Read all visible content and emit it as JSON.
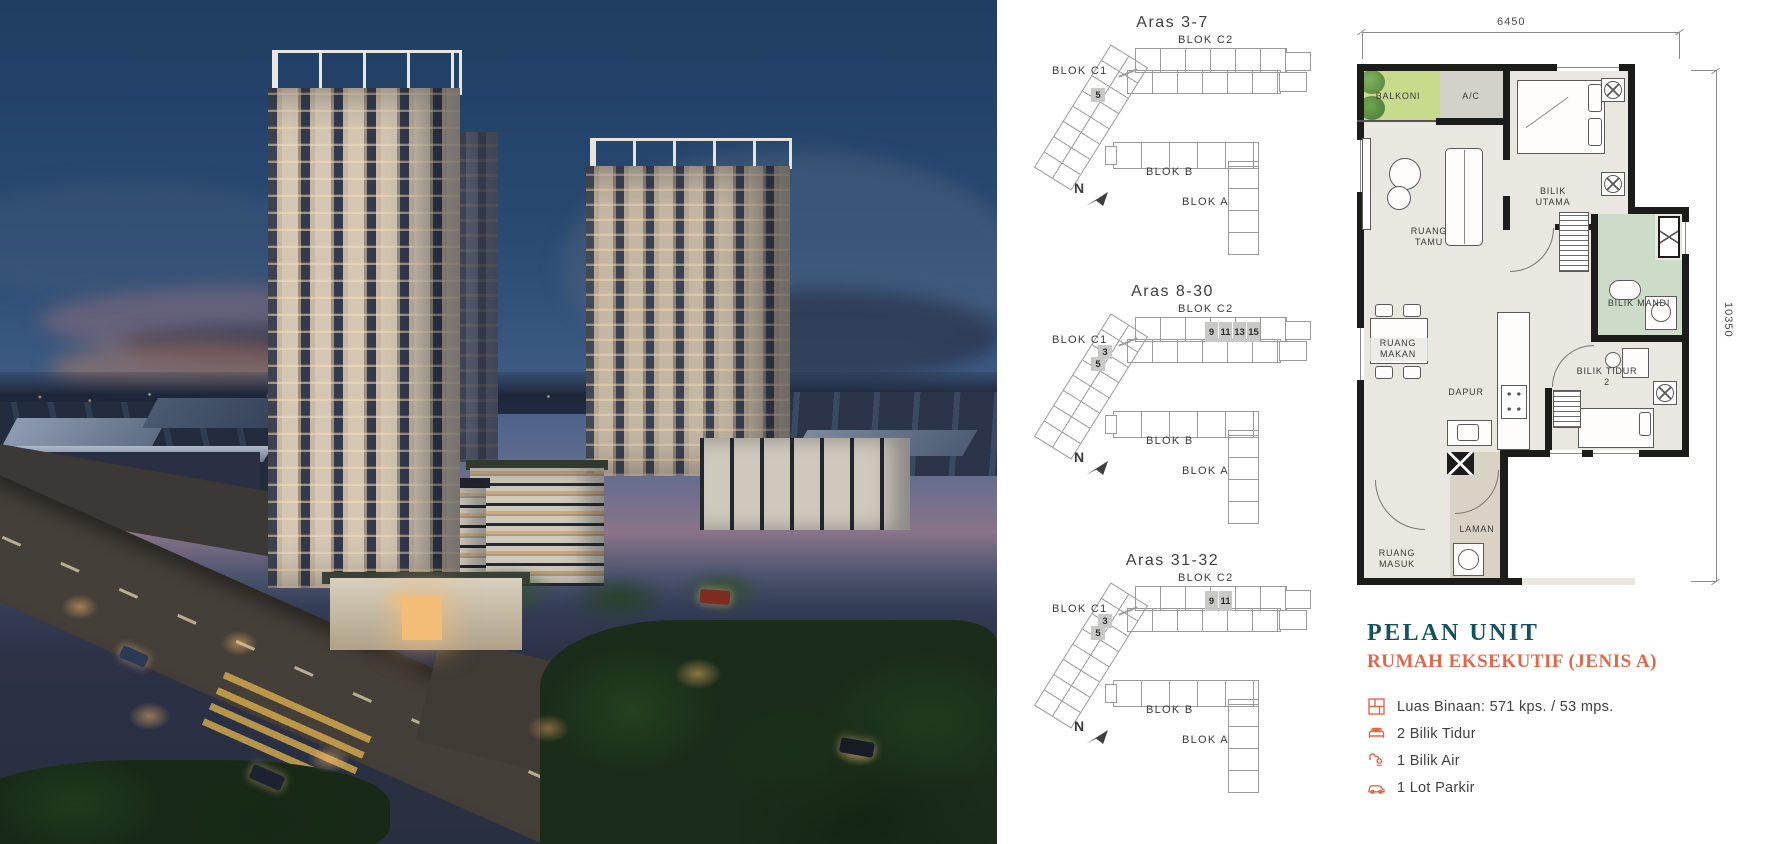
{
  "hero": {
    "description": "Twilight aerial render of condominium development with three high-rise towers, low-rise podium blocks, landscaped deck, entrance gate, roads and city skyline"
  },
  "site_plans": [
    {
      "title": "Aras 3-7",
      "blok_c1_label": "BLOK C1",
      "blok_c2_label": "BLOK C2",
      "blok_b_label": "BLOK B",
      "blok_a_label": "BLOK A",
      "north_label": "N",
      "c1_units": [
        "5"
      ],
      "c2_units": []
    },
    {
      "title": "Aras 8-30",
      "blok_c1_label": "BLOK C1",
      "blok_c2_label": "BLOK C2",
      "blok_b_label": "BLOK B",
      "blok_a_label": "BLOK A",
      "north_label": "N",
      "c1_units": [
        "3",
        "5"
      ],
      "c2_units": [
        "9",
        "11",
        "13",
        "15"
      ]
    },
    {
      "title": "Aras 31-32",
      "blok_c1_label": "BLOK C1",
      "blok_c2_label": "BLOK C2",
      "blok_b_label": "BLOK B",
      "blok_a_label": "BLOK A",
      "north_label": "N",
      "c1_units": [
        "3",
        "5"
      ],
      "c2_units": [
        "9",
        "11"
      ]
    }
  ],
  "floor_plan": {
    "width_dim": "6450",
    "height_dim": "10350",
    "rooms": {
      "balkoni": "BALKONI",
      "ac": "A/C",
      "bilik_utama": "BILIK UTAMA",
      "ruang_tamu": "RUANG TAMU",
      "ruang_makan": "RUANG MAKAN",
      "dapur": "DAPUR",
      "bilik_mandi": "BILIK MANDI",
      "bilik_tidur_2": "BILIK TIDUR 2",
      "laman": "LAMAN",
      "ruang_masuk": "RUANG MASUK"
    }
  },
  "unit_info": {
    "title": "PELAN UNIT",
    "subtitle": "RUMAH EKSEKUTIF (JENIS A)",
    "features": [
      {
        "icon": "floor-area-icon",
        "label": "Luas Binaan: 571 kps. / 53 mps."
      },
      {
        "icon": "bed-icon",
        "label": "2 Bilik Tidur"
      },
      {
        "icon": "bath-icon",
        "label": "1 Bilik Air"
      },
      {
        "icon": "car-icon",
        "label": "1 Lot Parkir"
      }
    ]
  },
  "colors": {
    "accent_teal": "#15525e",
    "accent_coral": "#e0674a",
    "plan_wall": "#1c1c1a",
    "plan_floor": "#e9e7e0",
    "plan_green": "#c8da8c",
    "plan_mint": "#cddcc9",
    "highlight_gray": "#c8c8c6"
  }
}
